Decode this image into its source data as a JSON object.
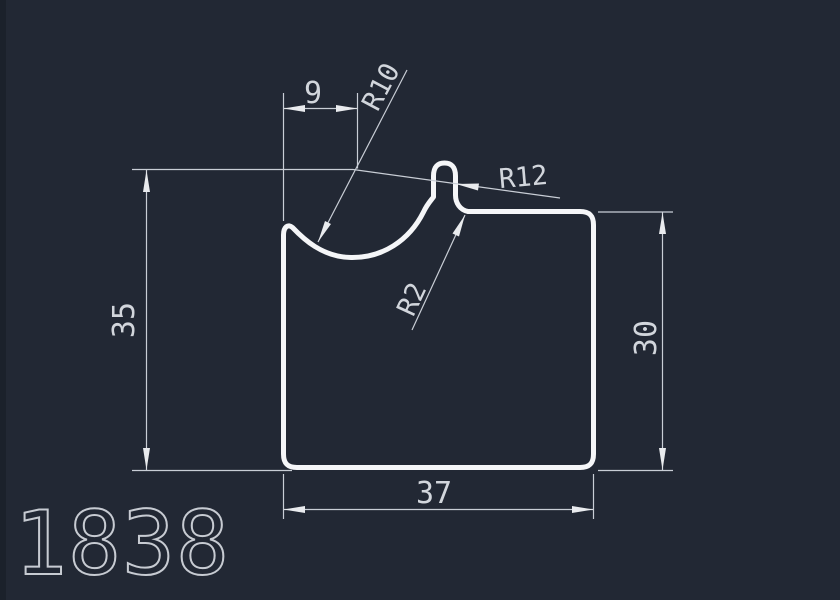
{
  "page": {
    "background_color": "#222834",
    "profile_line_color": "#f5f6f8",
    "dimension_line_color": "#c9ced6",
    "text_color": "#d2d6dc"
  },
  "drawing": {
    "part_number": "1838",
    "dimensions": {
      "top_width": "9",
      "left_height": "35",
      "right_height": "30",
      "bottom_width": "37"
    },
    "radii": {
      "cove": "R10",
      "shoulder": "R12",
      "fillet": "R2"
    }
  }
}
